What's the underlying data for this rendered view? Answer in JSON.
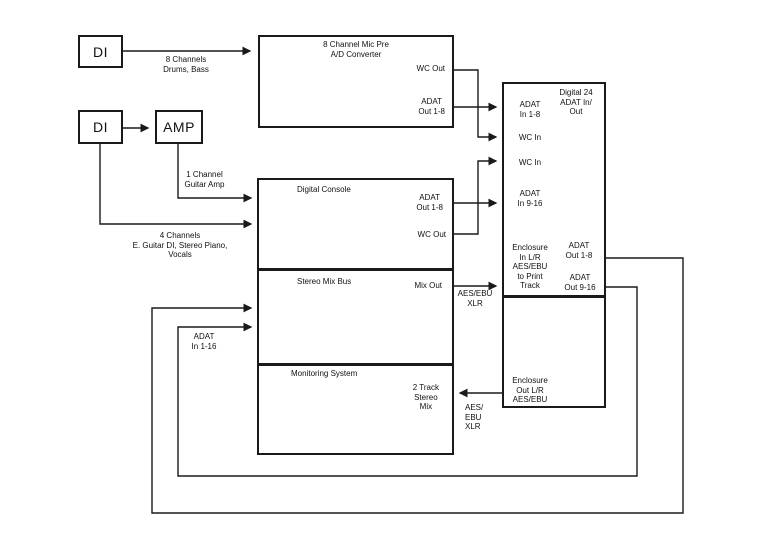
{
  "colors": {
    "line": "#1a1a1a",
    "background": "#ffffff",
    "text": "#111111"
  },
  "boxes": {
    "di_drums": {
      "label": "DI"
    },
    "di_guitar": {
      "label": "DI"
    },
    "amp": {
      "label": "AMP"
    },
    "mic_pre": {
      "title": [
        "8 Channel Mic Pre",
        "A/D Converter"
      ],
      "wc_out": "WC Out",
      "adat_out": [
        "ADAT",
        "Out 1-8"
      ]
    },
    "console": {
      "digital_console": {
        "title": "Digital Console",
        "adat_out": [
          "ADAT",
          "Out 1-8"
        ],
        "wc_out": "WC Out"
      },
      "stereo_mix_bus": {
        "title": "Stereo Mix Bus",
        "mix_out": "Mix Out"
      },
      "monitoring": {
        "title": "Monitoring System",
        "two_track": [
          "2 Track",
          "Stereo",
          "Mix"
        ]
      }
    },
    "digital24": {
      "title": [
        "Digital 24",
        "ADAT In/",
        "Out"
      ],
      "adat_in_1_8": [
        "ADAT",
        "In 1-8"
      ],
      "wc_in_1": "WC In",
      "wc_in_2": "WC In",
      "adat_in_9_16": [
        "ADAT",
        "In 9-16"
      ],
      "enclosure_in": [
        "Enclosure",
        "In L/R",
        "AES/EBU",
        "to Print",
        "Track"
      ],
      "adat_out_1_8": [
        "ADAT",
        "Out 1-8"
      ],
      "adat_out_9_16": [
        "ADAT",
        "Out 9-16"
      ],
      "enclosure_out": [
        "Enclosure",
        "Out L/R",
        "AES/EBU"
      ]
    }
  },
  "edge_labels": {
    "drums": [
      "8 Channels",
      "Drums, Bass"
    ],
    "guitar_amp": [
      "1 Channel",
      "Guitar Amp"
    ],
    "four_channels": [
      "4 Channels",
      "E. Guitar DI, Stereo Piano,",
      "Vocals"
    ],
    "adat_in_1_16": [
      "ADAT",
      "In 1-16"
    ],
    "mix_out_format": [
      "AES/EBU",
      "XLR"
    ],
    "two_track_format": [
      "AES/",
      "EBU",
      "XLR"
    ]
  }
}
